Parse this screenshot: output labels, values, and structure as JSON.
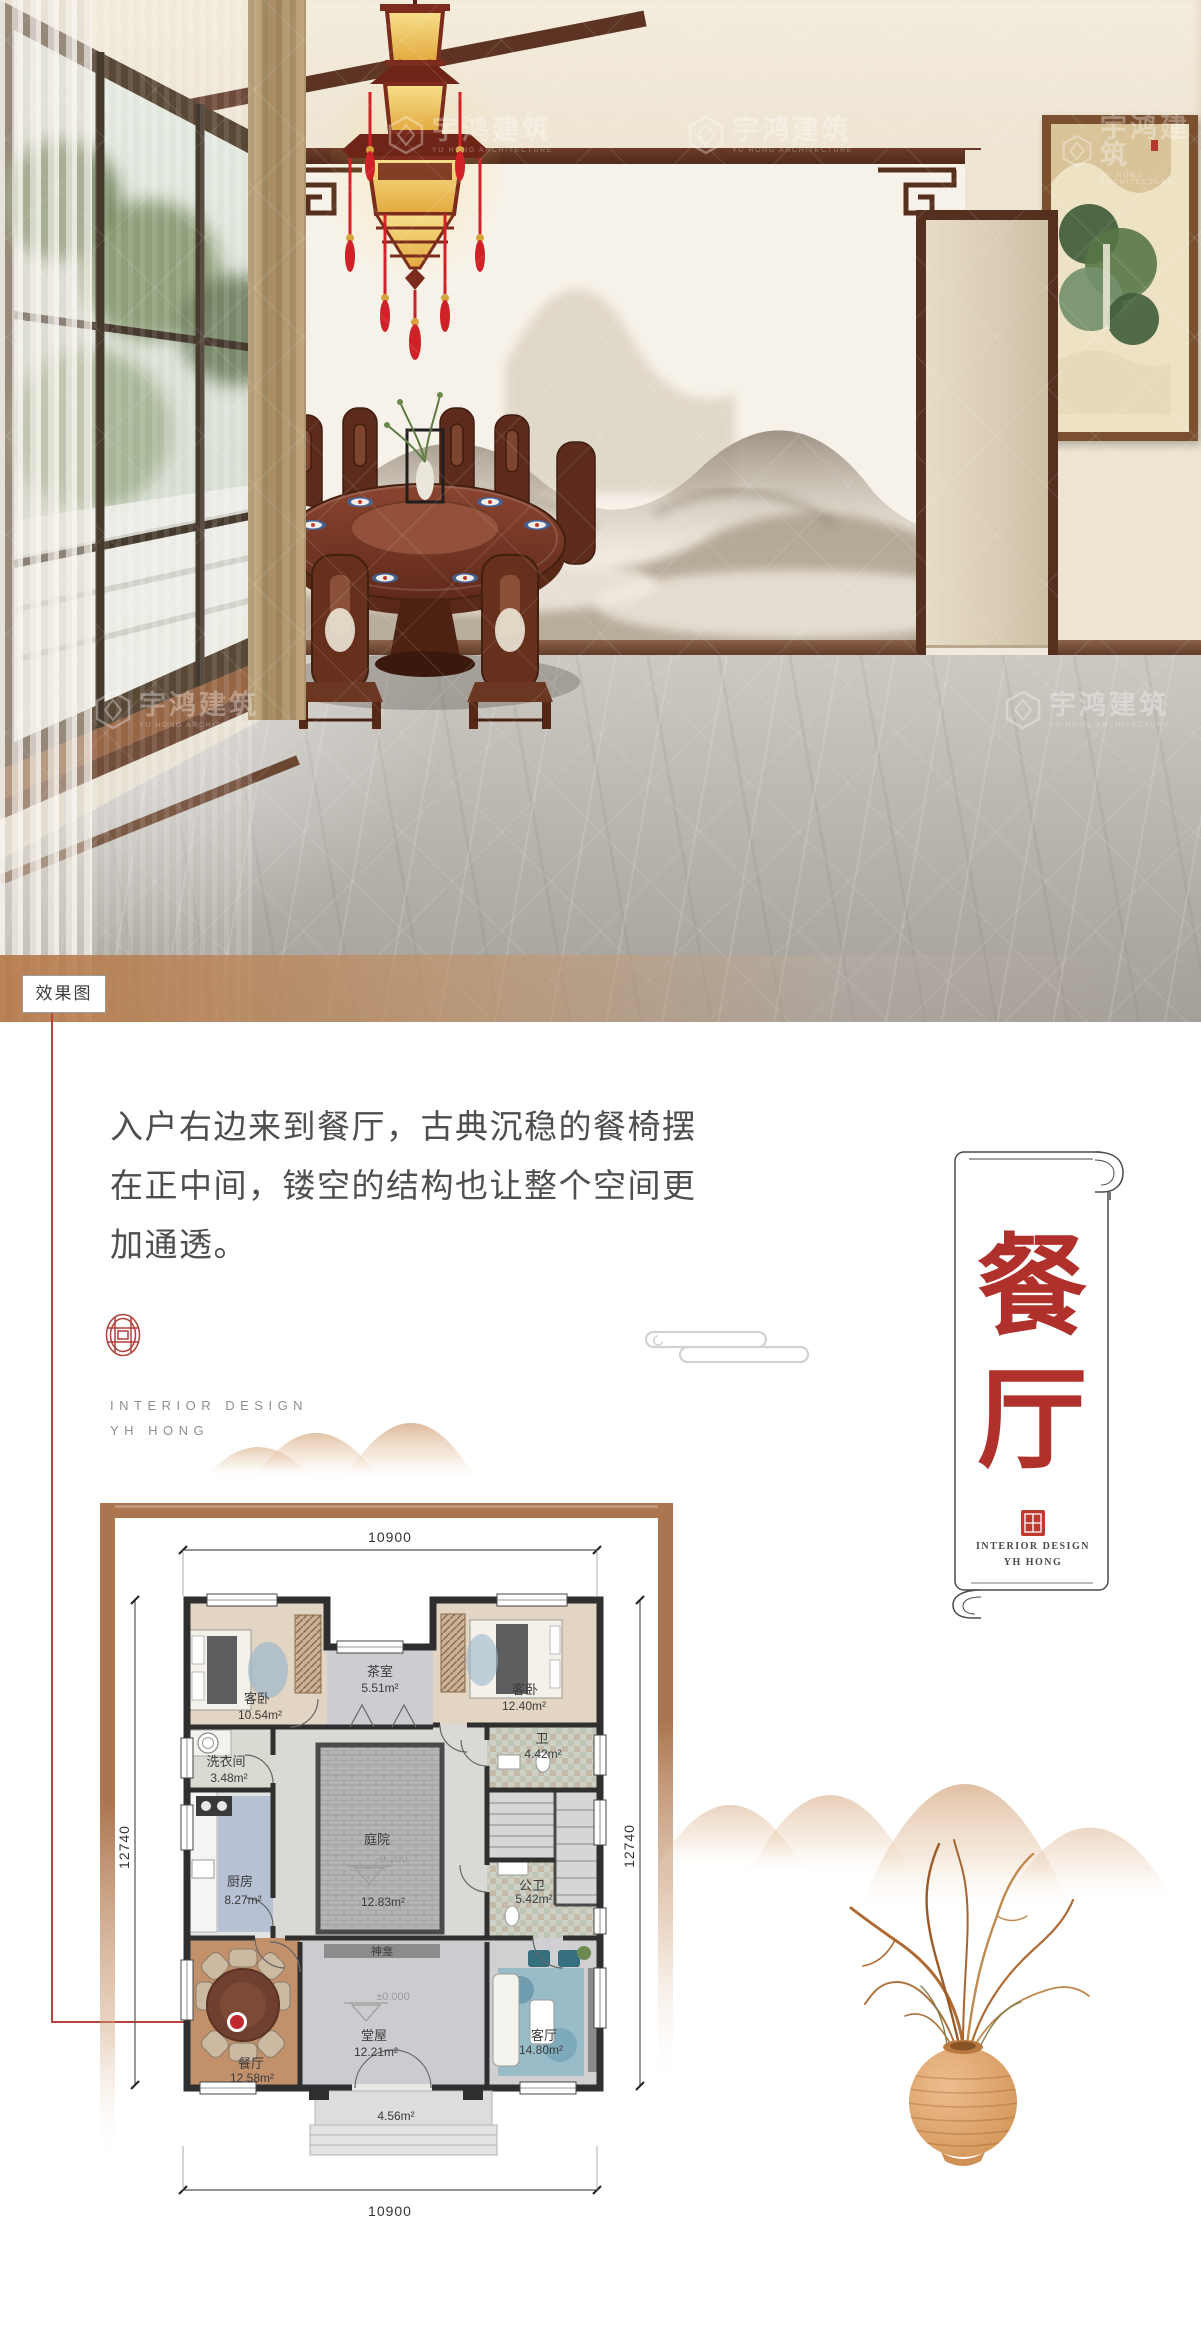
{
  "watermark": {
    "cn": "宇鸿建筑",
    "en": "YU HONG ARCHITECTURE"
  },
  "photo": {
    "tag": "效果图"
  },
  "intro": {
    "lines": [
      "入户右边来到餐厅，古典沉稳的餐椅摆",
      "在正中间，镂空的结构也让整个空间更",
      "加通透。"
    ]
  },
  "studio": {
    "line1": "INTERIOR DESIGN",
    "line2": "YH HONG"
  },
  "scroll": {
    "char1": "餐",
    "char2": "厅",
    "caption1": "INTERIOR DESIGN",
    "caption2": "YH HONG"
  },
  "floorplan": {
    "dim_top": "10900",
    "dim_bottom": "10900",
    "dim_left": "12740",
    "dim_right": "12740",
    "rooms": {
      "bedroom1": {
        "name": "客卧",
        "area": "10.54m²"
      },
      "tearoom": {
        "name": "茶室",
        "area": "5.51m²"
      },
      "bedroom2": {
        "name": "客卧",
        "area": "12.40m²"
      },
      "laundry": {
        "name": "洗衣间",
        "area": "3.48m²"
      },
      "kitchen": {
        "name": "厨房",
        "area": "8.27m²"
      },
      "courtyard": {
        "name": "庭院",
        "area": "12.83m²",
        "level": "-0.200"
      },
      "bath": {
        "name": "卫",
        "area": "4.42m²"
      },
      "public_bath": {
        "name": "公卫",
        "area": "5.42m²"
      },
      "dining": {
        "name": "餐厅",
        "area": "12.58m²"
      },
      "hall": {
        "name": "堂屋",
        "area": "12.21m²",
        "level": "±0.000"
      },
      "living": {
        "name": "客厅",
        "area": "14.80m²"
      },
      "shrine": {
        "name": "神龛"
      },
      "porch": {
        "area": "4.56m²"
      }
    }
  },
  "colors": {
    "accent_red": "#b2302d",
    "callout_red": "#b5443c",
    "frame_brown": "#ab7550",
    "mountain_tan": "#d8af88",
    "text_dark": "#4f4e4e",
    "text_gray": "#8f8f8f"
  }
}
